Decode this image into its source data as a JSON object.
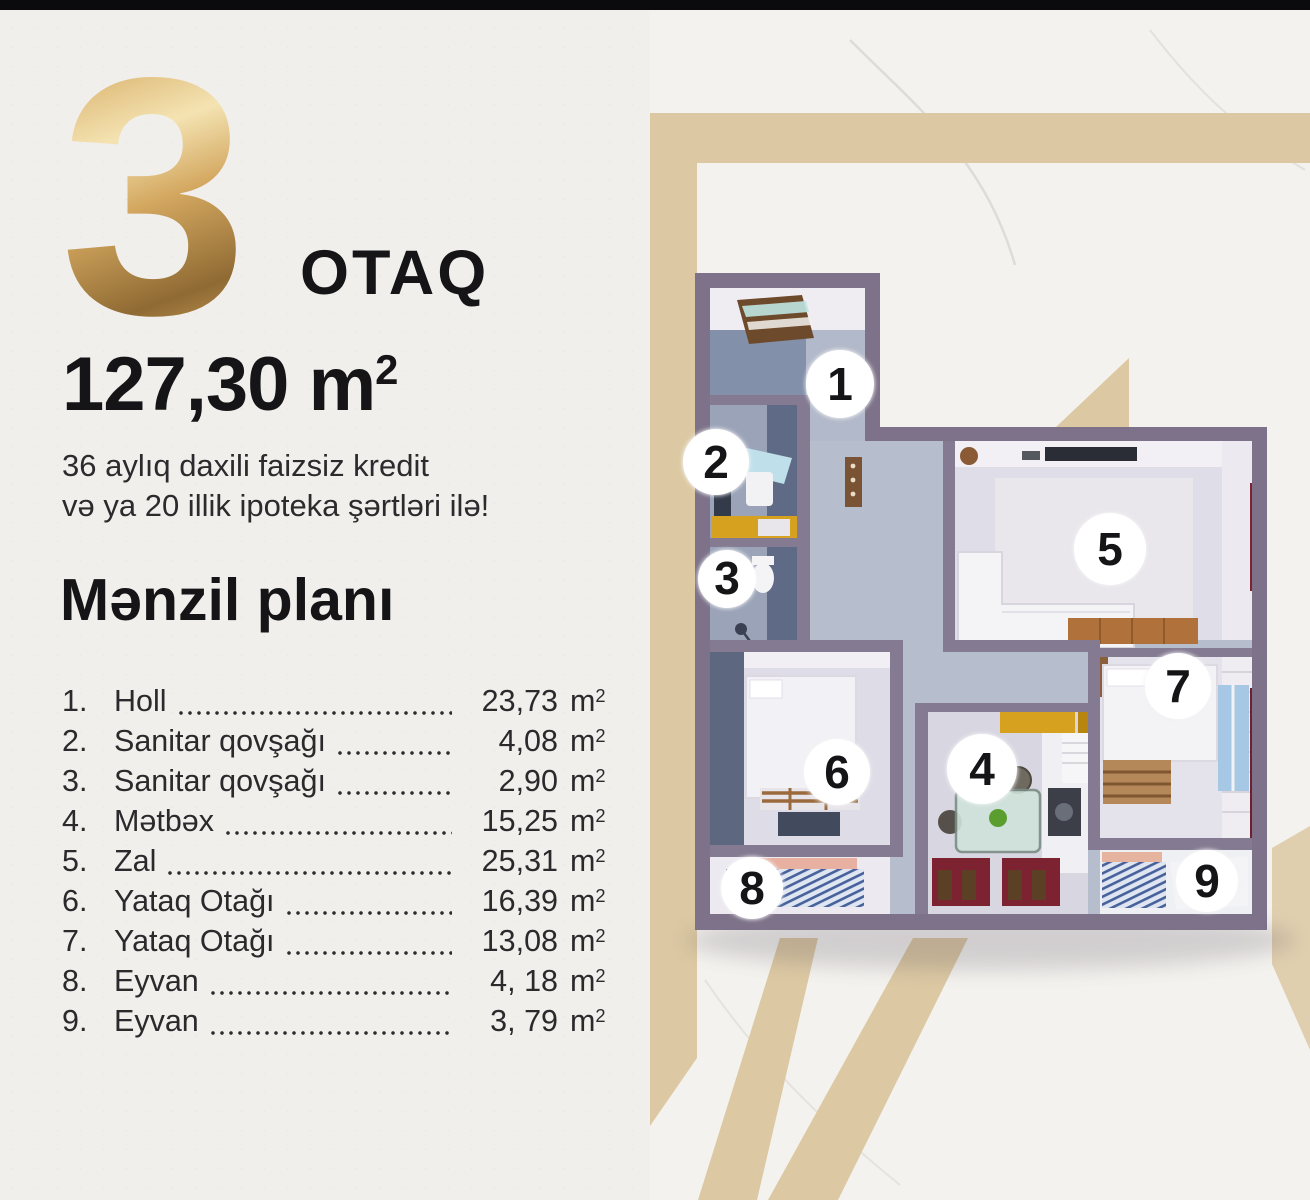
{
  "hero": {
    "room_count": "3",
    "room_count_label": "OTAQ",
    "area_value": "127,30",
    "credit_line1": "36 aylıq daxili faizsiz kredit",
    "credit_line2": "və ya 20 illik ipoteka şərtləri ilə!"
  },
  "plan": {
    "title": "Mənzil planı"
  },
  "units": {
    "m": "m",
    "sup": "2"
  },
  "rooms": [
    {
      "num": "1.",
      "badge": "1",
      "name": "Holl",
      "area": "23,73"
    },
    {
      "num": "2.",
      "badge": "2",
      "name": "Sanitar qovşağı",
      "area": "4,08"
    },
    {
      "num": "3.",
      "badge": "3",
      "name": "Sanitar qovşağı",
      "area": "2,90"
    },
    {
      "num": "4.",
      "badge": "4",
      "name": "Mətbəx",
      "area": "15,25"
    },
    {
      "num": "5.",
      "badge": "5",
      "name": "Zal",
      "area": "25,31"
    },
    {
      "num": "6.",
      "badge": "6",
      "name": "Yataq Otağı",
      "area": "16,39"
    },
    {
      "num": "7.",
      "badge": "7",
      "name": "Yataq Otağı",
      "area": "13,08"
    },
    {
      "num": "8.",
      "badge": "8",
      "name": "Eyvan",
      "area": "4, 18"
    },
    {
      "num": "9.",
      "badge": "9",
      "name": "Eyvan",
      "area": "3, 79"
    }
  ],
  "colors": {
    "gold": "#d3a75f",
    "tan_band": "#dcc9a3",
    "wall": "#7d7289",
    "accent_yellow": "#d6a11f",
    "maroon": "#77212c",
    "text": "#1d1d1f",
    "top_bar": "#0b0b0d"
  }
}
